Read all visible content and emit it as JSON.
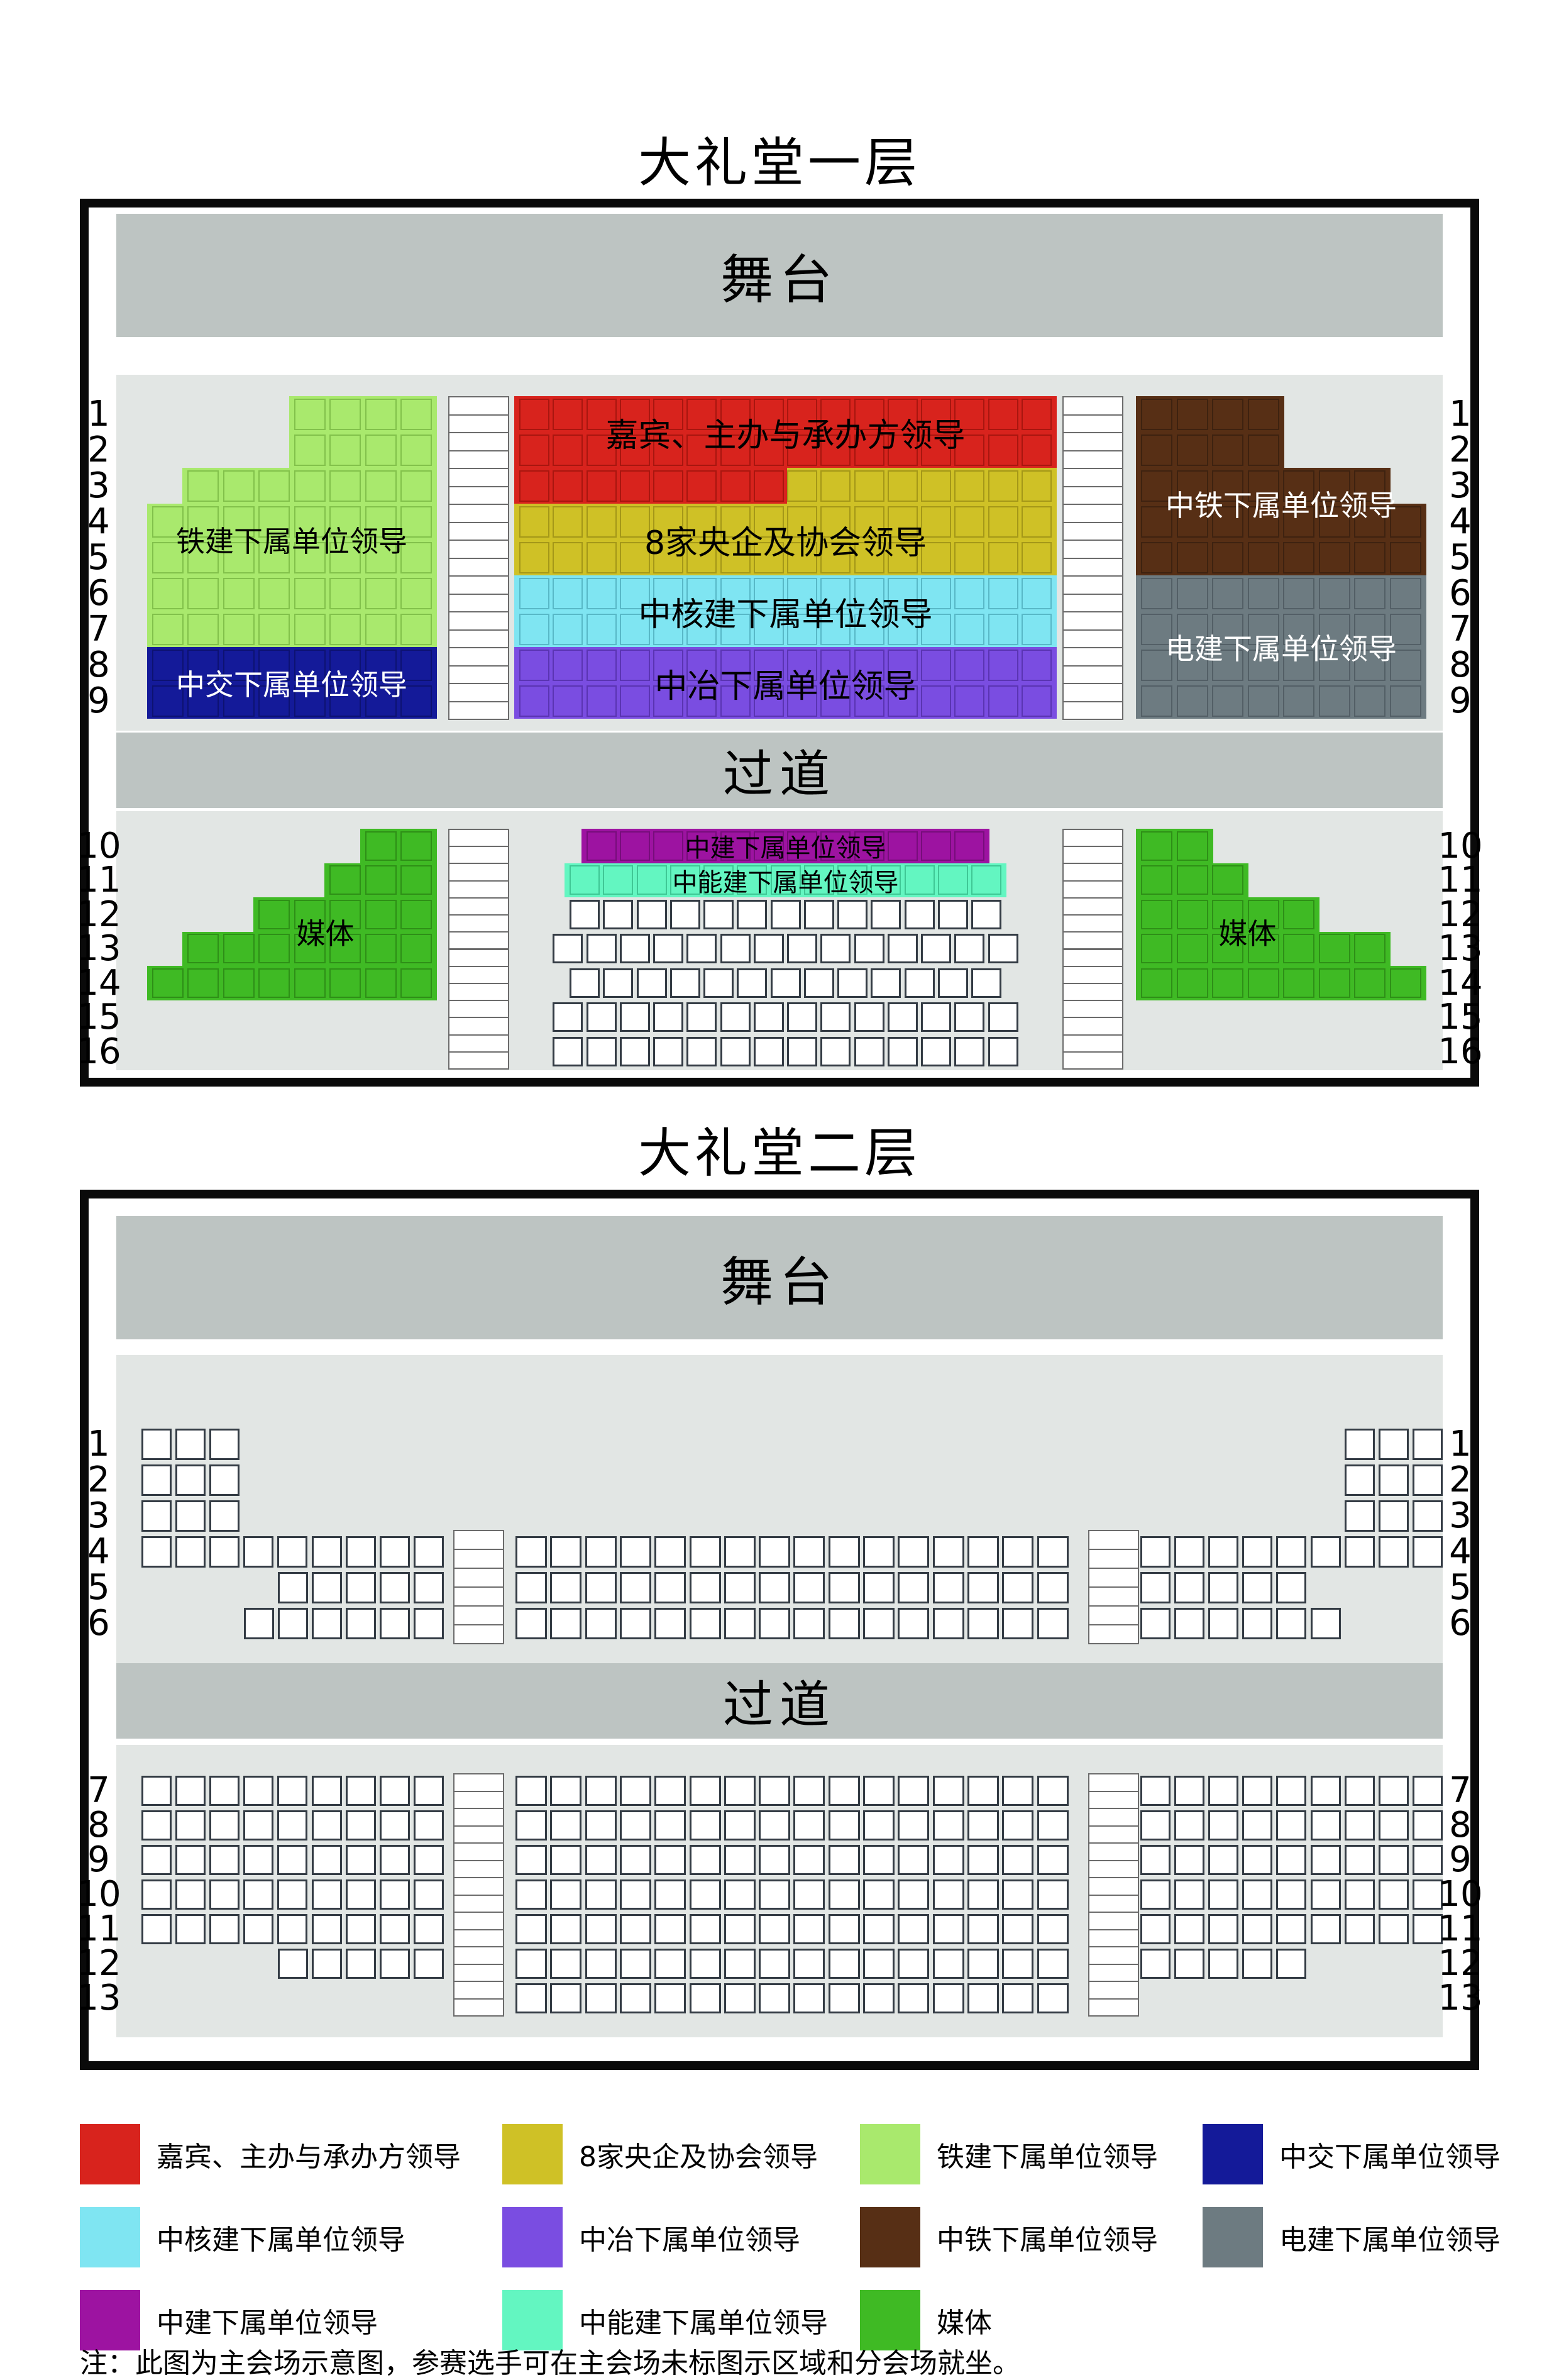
{
  "titles": {
    "floor1": "大礼堂一层",
    "floor2": "大礼堂二层"
  },
  "stage_label": "舞台",
  "aisle_label": "过道",
  "note": "注：此图为主会场示意图，参赛选手可在主会场未标图示区域和分会场就坐。",
  "colors": {
    "jiabin": {
      "fill": "#d8231d",
      "edge": "#a8160f"
    },
    "yangqi": {
      "fill": "#cfc126",
      "edge": "#a49718"
    },
    "tiejian": {
      "fill": "#a9e96d",
      "edge": "#82c14b"
    },
    "zhongjiao": {
      "fill": "#141a99",
      "edge": "#0d1272"
    },
    "hejian": {
      "fill": "#7fe5f2",
      "edge": "#58b8c7"
    },
    "zhongye": {
      "fill": "#7a4de1",
      "edge": "#5a34b2"
    },
    "zhongtie": {
      "fill": "#572f15",
      "edge": "#3e2210"
    },
    "dianjian": {
      "fill": "#6d7b81",
      "edge": "#535f66"
    },
    "zhongjian": {
      "fill": "#9d13a1",
      "edge": "#770d7b"
    },
    "nengjian": {
      "fill": "#63f6c1",
      "edge": "#3fc795"
    },
    "media": {
      "fill": "#3fba24",
      "edge": "#2e8f17"
    },
    "plain": {
      "fill": "#ffffff",
      "edge": "#333b44"
    }
  },
  "floor1": {
    "row_numbers_upper": [
      "1",
      "2",
      "3",
      "4",
      "5",
      "6",
      "7",
      "8",
      "9"
    ],
    "row_numbers_lower": [
      "10",
      "11",
      "12",
      "13",
      "14",
      "15",
      "16"
    ],
    "upper_left": {
      "align": "right",
      "rows": [
        {
          "segs": [
            [
              4,
              "tiejian"
            ]
          ]
        },
        {
          "segs": [
            [
              4,
              "tiejian"
            ]
          ]
        },
        {
          "segs": [
            [
              7,
              "tiejian"
            ]
          ]
        },
        {
          "segs": [
            [
              8,
              "tiejian"
            ]
          ]
        },
        {
          "segs": [
            [
              8,
              "tiejian"
            ]
          ]
        },
        {
          "segs": [
            [
              8,
              "tiejian"
            ]
          ]
        },
        {
          "segs": [
            [
              8,
              "tiejian"
            ]
          ]
        },
        {
          "segs": [
            [
              8,
              "zhongjiao"
            ]
          ]
        },
        {
          "segs": [
            [
              8,
              "zhongjiao"
            ]
          ]
        }
      ],
      "labels": [
        {
          "text": "铁建下属单位领导",
          "row": 3,
          "span": 2,
          "ink": "#000000"
        },
        {
          "text": "中交下属单位领导",
          "row": 7,
          "span": 2,
          "ink": "#ffffff"
        }
      ]
    },
    "upper_center": {
      "align": "left",
      "rows": [
        {
          "segs": [
            [
              16,
              "jiabin"
            ]
          ]
        },
        {
          "segs": [
            [
              16,
              "jiabin"
            ]
          ]
        },
        {
          "segs": [
            [
              8,
              "jiabin"
            ],
            [
              8,
              "yangqi"
            ]
          ]
        },
        {
          "segs": [
            [
              16,
              "yangqi"
            ]
          ]
        },
        {
          "segs": [
            [
              16,
              "yangqi"
            ]
          ]
        },
        {
          "segs": [
            [
              16,
              "hejian"
            ]
          ]
        },
        {
          "segs": [
            [
              16,
              "hejian"
            ]
          ]
        },
        {
          "segs": [
            [
              16,
              "zhongye"
            ]
          ]
        },
        {
          "segs": [
            [
              16,
              "zhongye"
            ]
          ]
        }
      ],
      "labels": [
        {
          "text": "嘉宾、主办与承办方领导",
          "row": 0,
          "span": 2,
          "ink": "#000000"
        },
        {
          "text": "8家央企及协会领导",
          "row": 3,
          "span": 2,
          "ink": "#000000"
        },
        {
          "text": "中核建下属单位领导",
          "row": 5,
          "span": 2,
          "ink": "#000000"
        },
        {
          "text": "中冶下属单位领导",
          "row": 7,
          "span": 2,
          "ink": "#000000"
        }
      ]
    },
    "upper_right": {
      "align": "left",
      "rows": [
        {
          "segs": [
            [
              4,
              "zhongtie"
            ]
          ]
        },
        {
          "segs": [
            [
              4,
              "zhongtie"
            ]
          ]
        },
        {
          "segs": [
            [
              7,
              "zhongtie"
            ]
          ]
        },
        {
          "segs": [
            [
              8,
              "zhongtie"
            ]
          ]
        },
        {
          "segs": [
            [
              8,
              "zhongtie"
            ]
          ]
        },
        {
          "segs": [
            [
              8,
              "dianjian"
            ]
          ]
        },
        {
          "segs": [
            [
              8,
              "dianjian"
            ]
          ]
        },
        {
          "segs": [
            [
              8,
              "dianjian"
            ]
          ]
        },
        {
          "segs": [
            [
              8,
              "dianjian"
            ]
          ]
        }
      ],
      "labels": [
        {
          "text": "中铁下属单位领导",
          "row": 2,
          "span": 2,
          "ink": "#ffffff"
        },
        {
          "text": "电建下属单位领导",
          "row": 6,
          "span": 2,
          "ink": "#ffffff"
        }
      ]
    },
    "lower_left": {
      "align": "right",
      "rows": [
        {
          "segs": [
            [
              2,
              "media"
            ]
          ]
        },
        {
          "segs": [
            [
              3,
              "media"
            ]
          ]
        },
        {
          "segs": [
            [
              5,
              "media"
            ]
          ]
        },
        {
          "segs": [
            [
              7,
              "media"
            ]
          ]
        },
        {
          "segs": [
            [
              8,
              "media"
            ]
          ]
        }
      ],
      "labels": [
        {
          "text": "媒体",
          "row": 2,
          "span": 2,
          "ink": "#000000",
          "cx": 0.62
        }
      ]
    },
    "lower_center": {
      "align": "center",
      "rows": [
        {
          "segs": [
            [
              12,
              "zhongjian"
            ]
          ]
        },
        {
          "segs": [
            [
              13,
              "nengjian"
            ]
          ]
        },
        {
          "segs": [
            [
              13,
              "plain"
            ]
          ]
        },
        {
          "segs": [
            [
              14,
              "plain"
            ]
          ]
        },
        {
          "segs": [
            [
              13,
              "plain"
            ]
          ]
        },
        {
          "segs": [
            [
              14,
              "plain"
            ]
          ]
        },
        {
          "segs": [
            [
              14,
              "plain"
            ]
          ]
        }
      ],
      "labels": [
        {
          "text": "中建下属单位领导",
          "row": 0,
          "span": 1,
          "ink": "#000000"
        },
        {
          "text": "中能建下属单位领导",
          "row": 1,
          "span": 1,
          "ink": "#000000"
        }
      ]
    },
    "lower_right": {
      "align": "left",
      "rows": [
        {
          "segs": [
            [
              2,
              "media"
            ]
          ]
        },
        {
          "segs": [
            [
              3,
              "media"
            ]
          ]
        },
        {
          "segs": [
            [
              5,
              "media"
            ]
          ]
        },
        {
          "segs": [
            [
              7,
              "media"
            ]
          ]
        },
        {
          "segs": [
            [
              8,
              "media"
            ]
          ]
        }
      ],
      "labels": [
        {
          "text": "媒体",
          "row": 2,
          "span": 2,
          "ink": "#000000",
          "cx": 0.38
        }
      ]
    }
  },
  "floor2": {
    "row_numbers_upper": [
      "1",
      "2",
      "3",
      "4",
      "5",
      "6"
    ],
    "row_numbers_lower": [
      "7",
      "8",
      "9",
      "10",
      "11",
      "12",
      "13"
    ],
    "upper_left": {
      "align": "left",
      "rows": [
        {
          "segs": [
            [
              3,
              "plain"
            ]
          ]
        },
        {
          "segs": [
            [
              3,
              "plain"
            ]
          ]
        },
        {
          "segs": [
            [
              3,
              "plain"
            ]
          ]
        },
        {
          "segs": [
            [
              9,
              "plain"
            ]
          ]
        },
        {
          "segs": [
            [
              5,
              "plain"
            ]
          ],
          "align": "right"
        },
        {
          "segs": [
            [
              6,
              "plain"
            ]
          ],
          "align": "right"
        }
      ],
      "labels": []
    },
    "upper_center": {
      "align": "left",
      "rows": [
        {
          "segs": [
            [
              16,
              "plain"
            ]
          ]
        },
        {
          "segs": [
            [
              16,
              "plain"
            ]
          ]
        },
        {
          "segs": [
            [
              16,
              "plain"
            ]
          ]
        }
      ],
      "labels": []
    },
    "upper_right": {
      "align": "right",
      "rows": [
        {
          "segs": [
            [
              3,
              "plain"
            ]
          ]
        },
        {
          "segs": [
            [
              3,
              "plain"
            ]
          ]
        },
        {
          "segs": [
            [
              3,
              "plain"
            ]
          ]
        },
        {
          "segs": [
            [
              9,
              "plain"
            ]
          ],
          "align": "left"
        },
        {
          "segs": [
            [
              5,
              "plain"
            ]
          ],
          "align": "left"
        },
        {
          "segs": [
            [
              6,
              "plain"
            ]
          ],
          "align": "left"
        }
      ],
      "labels": []
    },
    "lower_left": {
      "align": "left",
      "rows": [
        {
          "segs": [
            [
              9,
              "plain"
            ]
          ]
        },
        {
          "segs": [
            [
              9,
              "plain"
            ]
          ]
        },
        {
          "segs": [
            [
              9,
              "plain"
            ]
          ]
        },
        {
          "segs": [
            [
              9,
              "plain"
            ]
          ]
        },
        {
          "segs": [
            [
              9,
              "plain"
            ]
          ]
        },
        {
          "segs": [
            [
              5,
              "plain"
            ]
          ],
          "align": "right"
        },
        {
          "segs": [
            [
              0,
              "plain"
            ]
          ]
        }
      ],
      "labels": []
    },
    "lower_center": {
      "align": "left",
      "rows": [
        {
          "segs": [
            [
              16,
              "plain"
            ]
          ]
        },
        {
          "segs": [
            [
              16,
              "plain"
            ]
          ]
        },
        {
          "segs": [
            [
              16,
              "plain"
            ]
          ]
        },
        {
          "segs": [
            [
              16,
              "plain"
            ]
          ]
        },
        {
          "segs": [
            [
              16,
              "plain"
            ]
          ]
        },
        {
          "segs": [
            [
              16,
              "plain"
            ]
          ]
        },
        {
          "segs": [
            [
              16,
              "plain"
            ]
          ]
        }
      ],
      "labels": []
    },
    "lower_right": {
      "align": "left",
      "rows": [
        {
          "segs": [
            [
              9,
              "plain"
            ]
          ]
        },
        {
          "segs": [
            [
              9,
              "plain"
            ]
          ]
        },
        {
          "segs": [
            [
              9,
              "plain"
            ]
          ]
        },
        {
          "segs": [
            [
              9,
              "plain"
            ]
          ]
        },
        {
          "segs": [
            [
              9,
              "plain"
            ]
          ]
        },
        {
          "segs": [
            [
              5,
              "plain"
            ]
          ]
        },
        {
          "segs": [
            [
              0,
              "plain"
            ]
          ]
        }
      ],
      "labels": []
    }
  },
  "legend": {
    "rows": [
      [
        {
          "color": "jiabin",
          "label": "嘉宾、主办与承办方领导"
        },
        {
          "color": "yangqi",
          "label": "8家央企及协会领导"
        },
        {
          "color": "tiejian",
          "label": "铁建下属单位领导"
        },
        {
          "color": "zhongjiao",
          "label": "中交下属单位领导"
        }
      ],
      [
        {
          "color": "hejian",
          "label": "中核建下属单位领导"
        },
        {
          "color": "zhongye",
          "label": "中冶下属单位领导"
        },
        {
          "color": "zhongtie",
          "label": "中铁下属单位领导"
        },
        {
          "color": "dianjian",
          "label": "电建下属单位领导"
        }
      ],
      [
        {
          "color": "zhongjian",
          "label": "中建下属单位领导"
        },
        {
          "color": "nengjian",
          "label": "中能建下属单位领导"
        },
        {
          "color": "media",
          "label": "媒体"
        }
      ]
    ]
  }
}
